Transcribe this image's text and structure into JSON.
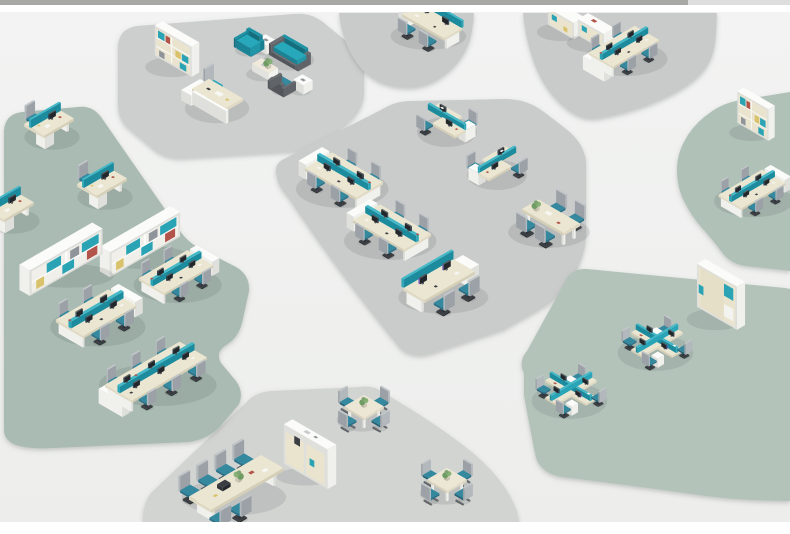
{
  "canvas": {
    "width": 790,
    "height": 534,
    "margin_color": "#ffffff",
    "content_top": 12,
    "content_bottom": 522
  },
  "top_bar": {
    "height": 5,
    "segments": [
      {
        "x": 0,
        "w": 688,
        "color": "#a8a8a6"
      },
      {
        "x": 688,
        "w": 102,
        "color": "#dedeba0"
      }
    ]
  },
  "floor": {
    "color_top": "#f2f3f2",
    "color_bottom": "#edeeec"
  },
  "palette": {
    "zone_gray": "#c9cbca",
    "zone_gray_light": "#cdcfce",
    "zone_gray_meeting": "#d2d4d2",
    "zone_green": "#a9bbb2",
    "zone_green_right": "#b0c1b8",
    "zone_green_lower": "#b3c3ba",
    "accent_teal": "#2aa5b7",
    "desk_cream": "#ebe6d1",
    "chair_seat_teal": "#2f7d96",
    "chair_back_gray": "#b2b8bc",
    "shadow": "rgba(80,86,84,0.15)"
  },
  "zones": [
    {
      "name": "zone-exec-office",
      "color": "#cdcfce",
      "path": "M118,48 Q118,29 137,26 L294,14 Q311,12 324,23 L352,46 Q364,57 364,71 L364,92 Q364,108 351,120 L329,140 Q318,149 303,151 L186,158 Q166,160 152,148 L127,127 Q118,118 118,104 Z"
    },
    {
      "name": "zone-top-left-team",
      "color": "#c9cbca",
      "path": "M339,13 Q342,42 357,63 Q371,83 396,87 Q422,91 442,77 Q463,62 470,40 Q473,28 474,13 Z"
    },
    {
      "name": "zone-top-right-team",
      "color": "#c9cbca",
      "path": "M523,13 Q526,44 537,70 Q549,97 571,112 Q584,121 601,118 Q639,111 671,95 Q697,82 707,66 Q715,54 716,34 L717,13 Z"
    },
    {
      "name": "zone-open-office-center",
      "color": "#cacccb",
      "path": "M277,177 Q273,166 282,160 L381,110 Q395,101 411,101 L505,99 Q527,99 544,112 L566,129 Q585,144 586,163 L586,233 Q586,255 573,277 Q560,298 537,311 L503,330 L436,352 Q415,360 401,349 Q340,275 288,197 Q278,186 277,177 Z"
    },
    {
      "name": "zone-right-upper-green",
      "color": "#b0c1b8",
      "path": "M790,92 L741,100 Q723,103 711,112 Q693,124 684,142 Q677,155 677,170 Q677,187 684,201 Q692,217 703,229 Q713,240 721,251 Q730,264 746,266 L790,271 Z"
    },
    {
      "name": "zone-right-lower-green",
      "color": "#b3c3ba",
      "path": "M524,373 Q518,361 527,351 L565,282 Q571,268 587,269 L785,288 L790,289 L790,501 Q745,501 706,496 Q627,485 562,477 Q542,474 536,458 Q529,424 524,395 Z"
    },
    {
      "name": "zone-meeting-area",
      "color": "#d2d4d2",
      "path": "M270,391 L360,387 Q373,385 382,392 Q436,423 473,453 Q502,478 513,502 Q518,512 519,522 L143,522 Q142,505 151,493 L251,398 Q259,392 270,391 Z"
    },
    {
      "name": "zone-left-green",
      "color": "#a9bbb2",
      "path": "M4,131 Q5,114 22,112 L78,107 Q92,105 101,117 L178,228 Q186,241 199,248 L236,267 Q250,275 249,291 L242,323 Q238,338 226,345 Q215,352 221,363 L236,381 Q244,392 239,404 L224,422 Q210,440 187,442 L54,448 Q17,450 8,440 Q4,436 4,430 Z"
    }
  ],
  "furniture": [
    {
      "type": "shelfT",
      "name": "exec-bookshelf",
      "cx": 177,
      "cy": 64,
      "s": 1.25,
      "m": false,
      "o": {
        "h": 24,
        "books": true
      }
    },
    {
      "type": "exec",
      "name": "exec-desk",
      "cx": 221,
      "cy": 106,
      "s": 1.15,
      "m": false,
      "o": {}
    },
    {
      "type": "chairT",
      "name": "lounge-armchair-teal",
      "cx": 248,
      "cy": 50,
      "s": 1.3,
      "m": false,
      "o": {}
    },
    {
      "type": "stable",
      "name": "lounge-side-table-1",
      "cx": 266,
      "cy": 49,
      "s": 1.3,
      "m": false,
      "o": {}
    },
    {
      "type": "sofa",
      "name": "lounge-sofa",
      "cx": 289,
      "cy": 60,
      "s": 1.05,
      "m": false,
      "o": {}
    },
    {
      "type": "ctable",
      "name": "lounge-coffee-table",
      "cx": 265,
      "cy": 73,
      "s": 1.2,
      "m": false,
      "o": {}
    },
    {
      "type": "chairG",
      "name": "lounge-armchair-gray",
      "cx": 283,
      "cy": 90,
      "s": 1.3,
      "m": false,
      "o": {}
    },
    {
      "type": "stable",
      "name": "lounge-side-table-2",
      "cx": 303,
      "cy": 89,
      "s": 1.3,
      "m": false,
      "o": {}
    },
    {
      "type": "row2",
      "name": "b1-workstation",
      "cx": 432,
      "cy": 34,
      "s": 1.05,
      "m": false,
      "o": {}
    },
    {
      "type": "cabL",
      "name": "b2-cabinet-1",
      "cx": 566,
      "cy": 29,
      "s": 1.5,
      "m": false,
      "o": {}
    },
    {
      "type": "cabL",
      "name": "b2-cabinet-2",
      "cx": 596,
      "cy": 40,
      "s": 1.5,
      "m": false,
      "o": {}
    },
    {
      "type": "ws4",
      "name": "b2-workstation-4",
      "cx": 624,
      "cy": 58,
      "s": 0.95,
      "m": true,
      "o": {
        "cab": 1
      }
    },
    {
      "type": "L2",
      "name": "c-l-workstation-a",
      "cx": 447,
      "cy": 132,
      "s": 1.0,
      "m": false,
      "o": {}
    },
    {
      "type": "ws4",
      "name": "c-workstation-4-a",
      "cx": 344,
      "cy": 188,
      "s": 1.05,
      "m": false,
      "o": {}
    },
    {
      "type": "L2",
      "name": "c-l-workstation-b",
      "cx": 497,
      "cy": 175,
      "s": 1.0,
      "m": true,
      "o": {}
    },
    {
      "type": "ws4",
      "name": "c-workstation-4-b",
      "cx": 392,
      "cy": 240,
      "s": 1.05,
      "m": false,
      "o": {}
    },
    {
      "type": "meet4",
      "name": "c-meeting-table",
      "cx": 551,
      "cy": 231,
      "s": 1.2,
      "m": false,
      "o": {}
    },
    {
      "type": "row2",
      "name": "c-workstation-2",
      "cx": 439,
      "cy": 295,
      "s": 1.25,
      "m": true,
      "o": {
        "scr": "#6b4fae"
      }
    },
    {
      "type": "shelfT",
      "name": "d-bookshelf",
      "cx": 756,
      "cy": 130,
      "s": 1.05,
      "m": false,
      "o": {
        "h": 30,
        "books": true
      }
    },
    {
      "type": "ws4",
      "name": "d-workstation",
      "cx": 752,
      "cy": 200,
      "s": 0.9,
      "m": true,
      "o": {}
    },
    {
      "type": "shelfT",
      "name": "e-bookshelf",
      "cx": 721,
      "cy": 316,
      "s": 1.35,
      "m": false,
      "o": {
        "h": 32,
        "door": true
      }
    },
    {
      "type": "cross4",
      "name": "e-cluster-2",
      "cx": 657,
      "cy": 352,
      "s": 0.9,
      "m": false,
      "o": {}
    },
    {
      "type": "cross4",
      "name": "e-cluster-1",
      "cx": 571,
      "cy": 400,
      "s": 0.9,
      "m": false,
      "o": {}
    },
    {
      "type": "desk1",
      "name": "g-desk-1",
      "cx": 50,
      "cy": 136,
      "s": 1.15,
      "m": true,
      "o": {}
    },
    {
      "type": "desk1",
      "name": "g-desk-2",
      "cx": 103,
      "cy": 196,
      "s": 1.15,
      "m": true,
      "o": {}
    },
    {
      "type": "desk1",
      "name": "g-desk-3",
      "cx": 10,
      "cy": 220,
      "s": 1.15,
      "m": true,
      "o": {}
    },
    {
      "type": "shelfL",
      "name": "g-bookshelf-low-2",
      "cx": 140,
      "cy": 254,
      "s": 1.45,
      "m": true,
      "o": {}
    },
    {
      "type": "shelfL",
      "name": "g-bookshelf-low-1",
      "cx": 61,
      "cy": 272,
      "s": 1.5,
      "m": true,
      "o": {}
    },
    {
      "type": "ws4",
      "name": "g-workstation-4-a",
      "cx": 176,
      "cy": 284,
      "s": 1.0,
      "m": true,
      "o": {}
    },
    {
      "type": "ws4",
      "name": "g-workstation-4-b",
      "cx": 96,
      "cy": 326,
      "s": 1.08,
      "m": true,
      "o": {}
    },
    {
      "type": "ws6",
      "name": "g-workstation-6",
      "cx": 156,
      "cy": 384,
      "s": 1.05,
      "m": true,
      "o": {
        "cab": 1
      }
    },
    {
      "type": "square4",
      "name": "meeting-square-1",
      "cx": 364,
      "cy": 419,
      "s": 1.15,
      "m": false,
      "o": {}
    },
    {
      "type": "credenza",
      "name": "meeting-credenza",
      "cx": 310,
      "cy": 474,
      "s": 1.1,
      "m": false,
      "o": {}
    },
    {
      "type": "conf",
      "name": "conference-set",
      "cx": 225,
      "cy": 492,
      "s": 1.3,
      "m": true,
      "o": {}
    },
    {
      "type": "square4",
      "name": "meeting-square-2",
      "cx": 447,
      "cy": 492,
      "s": 1.15,
      "m": false,
      "o": {}
    }
  ]
}
